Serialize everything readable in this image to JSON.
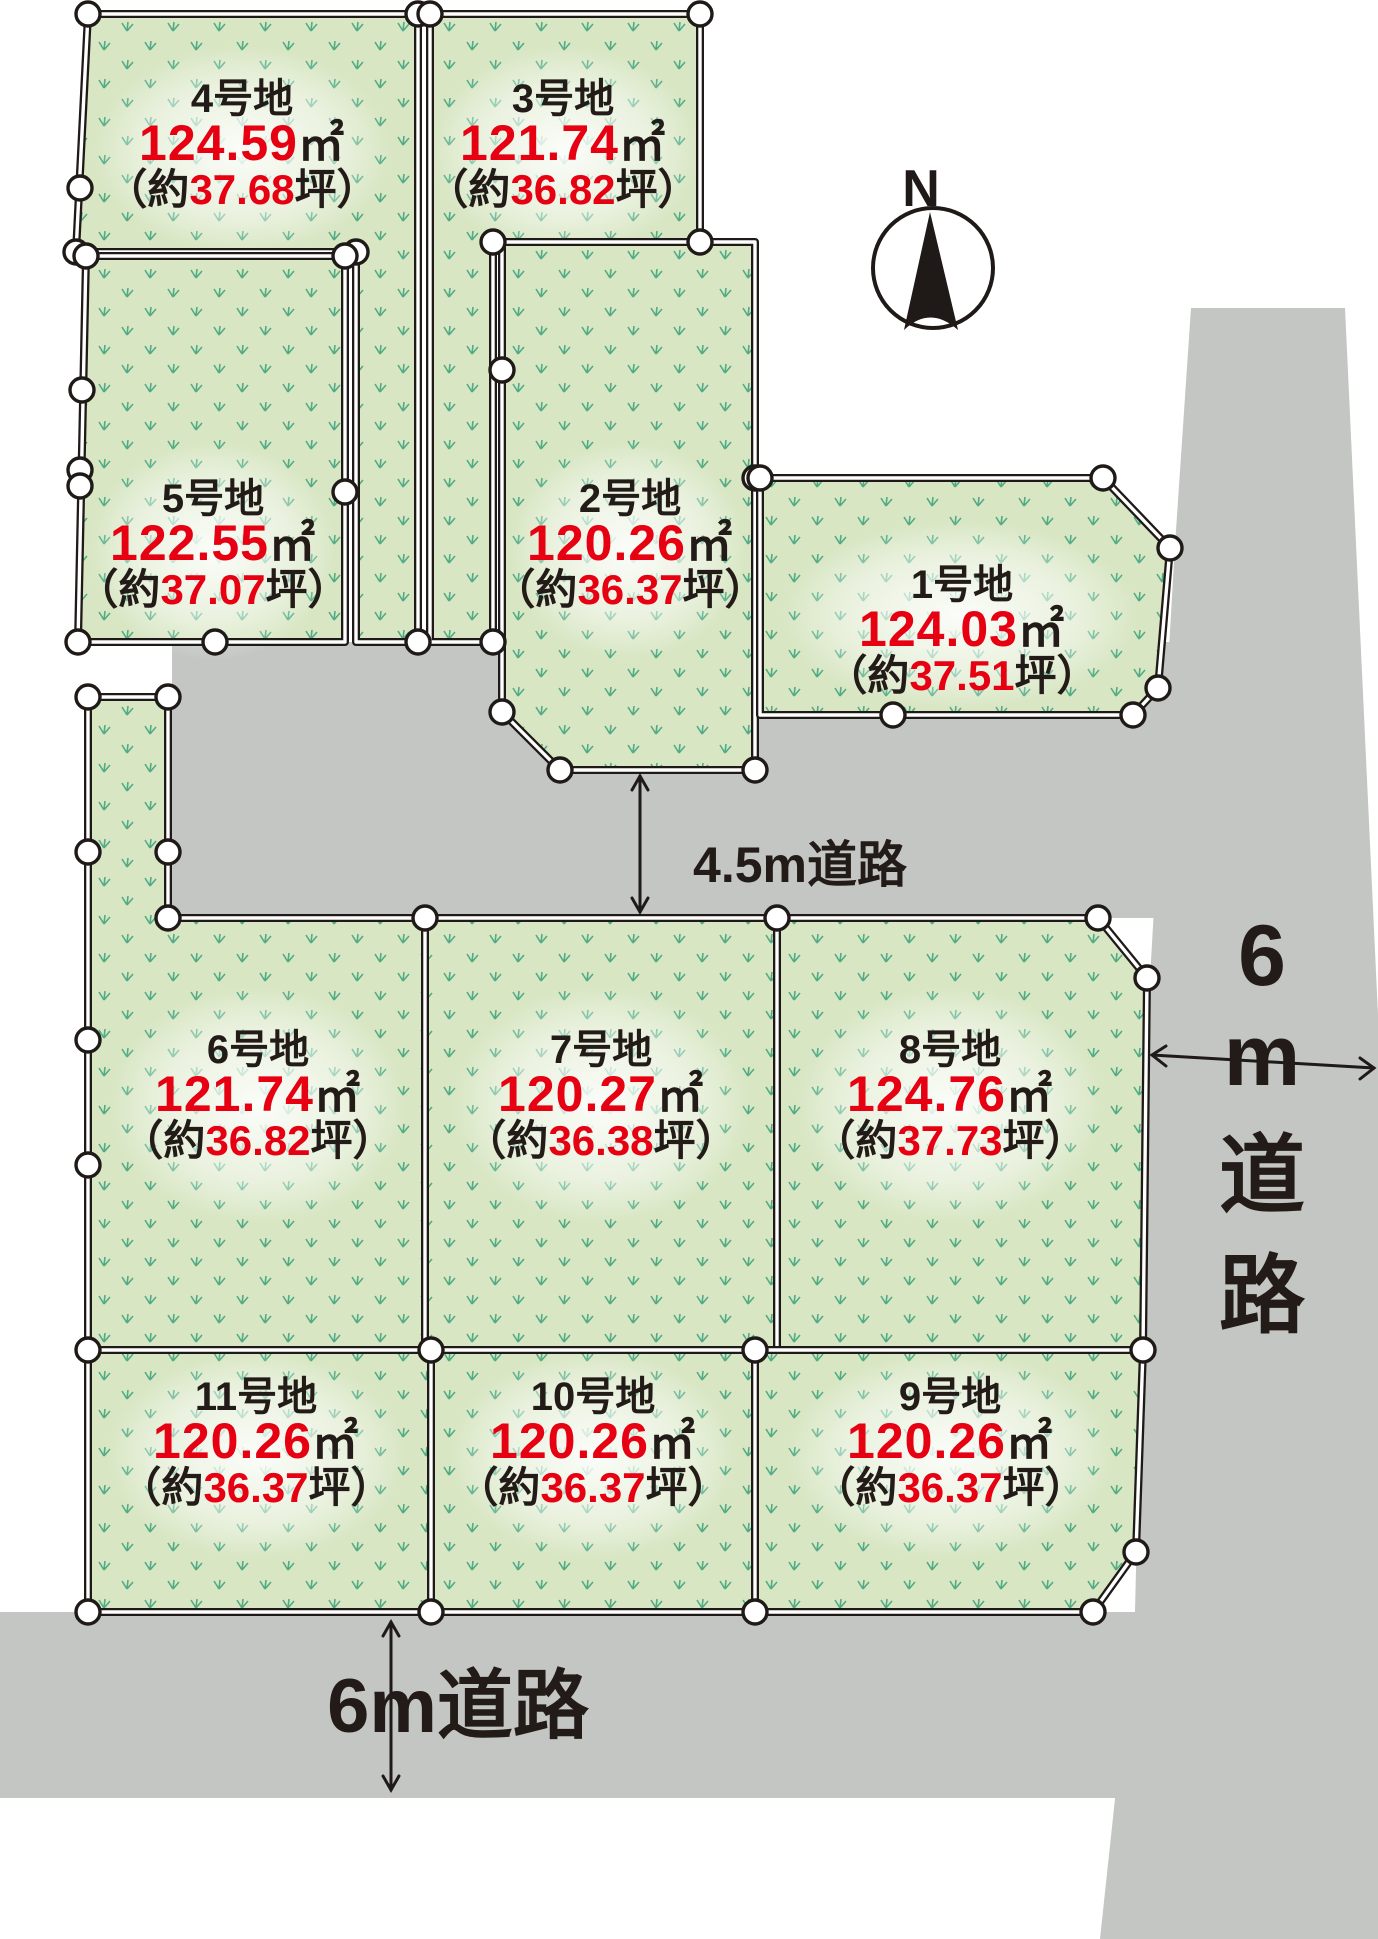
{
  "compass": {
    "label": "N"
  },
  "roads": {
    "middle_label": "4.5m道路",
    "bottom_label": "6m道路",
    "right_label": "6m道路",
    "right_label_chars": [
      "6",
      "m",
      "道",
      "路"
    ]
  },
  "lots": [
    {
      "name": "1号地",
      "area_num": "124.03",
      "area_unit": "㎡",
      "tsubo_prefix": "（約",
      "tsubo_num": "37.51",
      "tsubo_suffix": "坪）"
    },
    {
      "name": "2号地",
      "area_num": "120.26",
      "area_unit": "㎡",
      "tsubo_prefix": "（約",
      "tsubo_num": "36.37",
      "tsubo_suffix": "坪）"
    },
    {
      "name": "3号地",
      "area_num": "121.74",
      "area_unit": "㎡",
      "tsubo_prefix": "（約",
      "tsubo_num": "36.82",
      "tsubo_suffix": "坪）"
    },
    {
      "name": "4号地",
      "area_num": "124.59",
      "area_unit": "㎡",
      "tsubo_prefix": "（約",
      "tsubo_num": "37.68",
      "tsubo_suffix": "坪）"
    },
    {
      "name": "5号地",
      "area_num": "122.55",
      "area_unit": "㎡",
      "tsubo_prefix": "（約",
      "tsubo_num": "37.07",
      "tsubo_suffix": "坪）"
    },
    {
      "name": "6号地",
      "area_num": "121.74",
      "area_unit": "㎡",
      "tsubo_prefix": "（約",
      "tsubo_num": "36.82",
      "tsubo_suffix": "坪）"
    },
    {
      "name": "7号地",
      "area_num": "120.27",
      "area_unit": "㎡",
      "tsubo_prefix": "（約",
      "tsubo_num": "36.38",
      "tsubo_suffix": "坪）"
    },
    {
      "name": "8号地",
      "area_num": "124.76",
      "area_unit": "㎡",
      "tsubo_prefix": "（約",
      "tsubo_num": "37.73",
      "tsubo_suffix": "坪）"
    },
    {
      "name": "9号地",
      "area_num": "120.26",
      "area_unit": "㎡",
      "tsubo_prefix": "（約",
      "tsubo_num": "36.37",
      "tsubo_suffix": "坪）"
    },
    {
      "name": "10号地",
      "area_num": "120.26",
      "area_unit": "㎡",
      "tsubo_prefix": "（約",
      "tsubo_num": "36.37",
      "tsubo_suffix": "坪）"
    },
    {
      "name": "11号地",
      "area_num": "120.26",
      "area_unit": "㎡",
      "tsubo_prefix": "（約",
      "tsubo_num": "36.37",
      "tsubo_suffix": "坪）"
    }
  ],
  "colors": {
    "accent_red": "#e60012",
    "text_dark": "#221b17",
    "road_gray": "#c3c6c3",
    "lot_green": "#d8e6c3",
    "grass_green": "#2f9c74"
  }
}
